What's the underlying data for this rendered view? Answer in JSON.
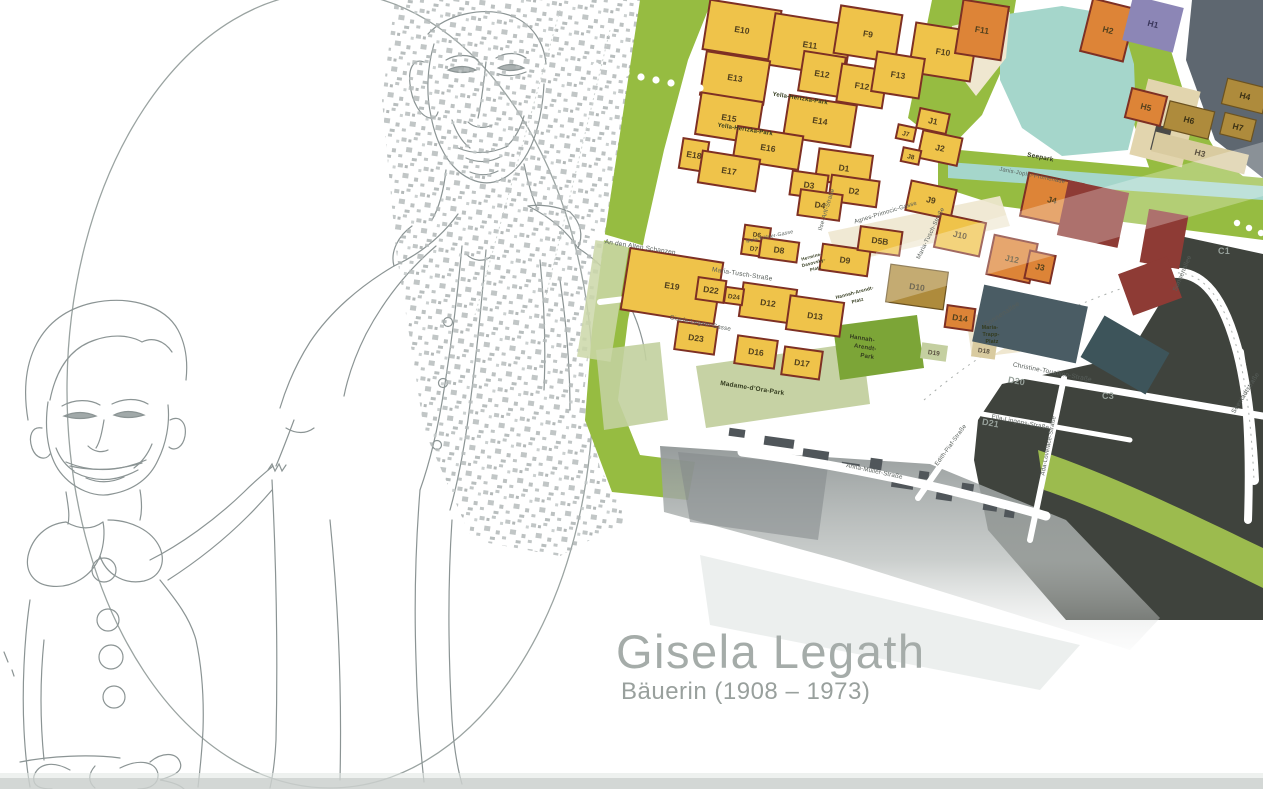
{
  "title": {
    "name": "Gisela Legath",
    "subtitle": "Bäuerin (1908 – 1973)"
  },
  "map": {
    "palette": {
      "Y": "#EFC34A",
      "O": "#DD8437",
      "OL": "#AE8B3C",
      "P": "#8C86B6",
      "MR": "#8E3B35",
      "SL": "#4A5C64",
      "SL2": "#3D545A",
      "DK": "#3F433D",
      "BG": "#D9CBA0",
      "PG": "#C4CFA0",
      "edge": "#7E3024",
      "street_label": "#575E5A",
      "park_label": "#333B1E",
      "dark_label": "#97A19B",
      "block_label": "#53411D"
    },
    "blocks": [
      [
        "E10",
        742,
        30,
        72,
        50,
        9,
        "Y"
      ],
      [
        "E11",
        810,
        45,
        78,
        52,
        9,
        "Y"
      ],
      [
        "F9",
        868,
        34,
        62,
        48,
        9,
        "Y"
      ],
      [
        "F10",
        943,
        52,
        62,
        50,
        9,
        "Y"
      ],
      [
        "F11",
        982,
        30,
        46,
        54,
        9,
        "O"
      ],
      [
        "H2",
        1108,
        30,
        44,
        54,
        14,
        "O"
      ],
      [
        "H1",
        1153,
        24,
        52,
        46,
        14,
        "P"
      ],
      [
        "E13",
        735,
        78,
        64,
        44,
        9,
        "Y"
      ],
      [
        "E12",
        822,
        74,
        42,
        40,
        9,
        "Y"
      ],
      [
        "F12",
        862,
        86,
        46,
        38,
        9,
        "Y"
      ],
      [
        "F13",
        898,
        75,
        48,
        40,
        9,
        "Y"
      ],
      [
        "E15",
        729,
        118,
        62,
        42,
        9,
        "Y"
      ],
      [
        "E14",
        820,
        121,
        68,
        42,
        9,
        "Y"
      ],
      [
        "E16",
        768,
        148,
        66,
        34,
        9,
        "Y"
      ],
      [
        "E18",
        694,
        155,
        26,
        30,
        9,
        "Y"
      ],
      [
        "E17",
        729,
        171,
        58,
        32,
        9,
        "Y"
      ],
      [
        "E19",
        672,
        286,
        94,
        62,
        9,
        "Y"
      ],
      [
        "J1",
        933,
        121,
        30,
        20,
        12,
        "Y"
      ],
      [
        "J7",
        906,
        133,
        18,
        14,
        12,
        "Y"
      ],
      [
        "J2",
        940,
        148,
        40,
        28,
        12,
        "Y"
      ],
      [
        "J8",
        911,
        156,
        18,
        14,
        12,
        "Y"
      ],
      [
        "J9",
        931,
        200,
        46,
        30,
        12,
        "Y"
      ],
      [
        "J10",
        960,
        235,
        46,
        34,
        12,
        "Y"
      ],
      [
        "J12",
        1012,
        259,
        44,
        40,
        12,
        "O"
      ],
      [
        "J3",
        1040,
        267,
        26,
        28,
        12,
        "O"
      ],
      [
        "J4",
        1052,
        200,
        56,
        44,
        12,
        "O"
      ],
      [
        "",
        1093,
        214,
        62,
        56,
        12,
        "MR"
      ],
      [
        "",
        1164,
        239,
        40,
        54,
        10,
        "MR"
      ],
      [
        "",
        1150,
        286,
        52,
        44,
        -20,
        "MR"
      ],
      [
        "H5",
        1146,
        107,
        36,
        30,
        14,
        "O"
      ],
      [
        "H3",
        1200,
        153,
        96,
        20,
        14,
        "BG"
      ],
      [
        "H6",
        1189,
        120,
        46,
        28,
        14,
        "OL"
      ],
      [
        "H4",
        1245,
        96,
        42,
        26,
        14,
        "OL"
      ],
      [
        "H7",
        1238,
        127,
        32,
        22,
        14,
        "OL"
      ],
      [
        "D1",
        844,
        168,
        54,
        32,
        8,
        "Y"
      ],
      [
        "D2",
        854,
        191,
        48,
        26,
        8,
        "Y"
      ],
      [
        "D3",
        809,
        185,
        36,
        24,
        8,
        "Y"
      ],
      [
        "D4",
        820,
        205,
        42,
        26,
        8,
        "Y"
      ],
      [
        "D6",
        757,
        234,
        26,
        15,
        8,
        "Y"
      ],
      [
        "D7",
        754,
        248,
        24,
        15,
        8,
        "Y"
      ],
      [
        "D8",
        779,
        250,
        38,
        20,
        8,
        "Y"
      ],
      [
        "D9",
        845,
        260,
        48,
        26,
        8,
        "Y"
      ],
      [
        "D5B",
        880,
        241,
        42,
        24,
        8,
        "Y"
      ],
      [
        "D10",
        917,
        287,
        58,
        38,
        8,
        "OL"
      ],
      [
        "D12",
        768,
        303,
        54,
        34,
        8,
        "Y"
      ],
      [
        "D13",
        815,
        316,
        54,
        34,
        8,
        "Y"
      ],
      [
        "D22",
        711,
        290,
        28,
        22,
        8,
        "Y"
      ],
      [
        "D24",
        734,
        296,
        18,
        16,
        8,
        "Y"
      ],
      [
        "D23",
        696,
        338,
        40,
        28,
        8,
        "Y"
      ],
      [
        "D16",
        756,
        352,
        40,
        28,
        8,
        "Y"
      ],
      [
        "D17",
        802,
        363,
        38,
        28,
        8,
        "Y"
      ],
      [
        "D14",
        960,
        318,
        28,
        22,
        8,
        "O"
      ],
      [
        "D18",
        984,
        350,
        24,
        16,
        8,
        "BG"
      ],
      [
        "D19",
        934,
        352,
        26,
        16,
        8,
        "PG"
      ],
      [
        "",
        1030,
        324,
        106,
        58,
        12,
        "SL"
      ],
      [
        "",
        1125,
        355,
        75,
        48,
        30,
        "SL2"
      ]
    ],
    "street_labels": [
      [
        "An den Alten Schanzen",
        640,
        249,
        9,
        6.5
      ],
      [
        "Maria-Tusch-Straße",
        742,
        276,
        9,
        6.5
      ],
      [
        "Maria-Tusch-Straße",
        932,
        234,
        -64,
        6
      ],
      [
        "Ilse-Arlt-Straße",
        828,
        210,
        -73,
        6
      ],
      [
        "Agnes-Primocic-Gasse",
        886,
        214,
        -17,
        6
      ],
      [
        "Gisela-Legath-Gasse",
        700,
        325,
        11,
        6.2
      ],
      [
        "Sonnenallee",
        1003,
        316,
        -33,
        7
      ],
      [
        "Sonnenallee",
        1184,
        274,
        -67,
        6.5
      ],
      [
        "Christine-Touaillon-Straße",
        1052,
        374,
        11,
        6.5
      ],
      [
        "Ella-Lingens-Straße",
        1020,
        424,
        11,
        6.2
      ],
      [
        "Ada-Lovelace-Straße",
        1050,
        446,
        -79,
        6
      ],
      [
        "Edith-Piaf-Straße",
        952,
        446,
        -54,
        6
      ],
      [
        "Anna-Müller-Straße",
        874,
        473,
        12,
        6.2
      ],
      [
        "Seestadtstraße",
        1247,
        394,
        -58,
        6.5
      ],
      [
        "Janis-Joplin-Promenade",
        1032,
        177,
        11,
        5.8
      ],
      [
        "Mela-Köhler-Gasse",
        770,
        238,
        -12,
        5.2
      ]
    ],
    "park_labels": [
      [
        "Yella-Hertzka-Park",
        800,
        100,
        9,
        6
      ],
      [
        "Yella-Hertzka-Park",
        745,
        131,
        9,
        6
      ],
      [
        "Seepark",
        1040,
        159,
        11,
        6.5
      ],
      [
        "Hannah-",
        862,
        340,
        9,
        6
      ],
      [
        "Arendt-",
        865,
        349,
        9,
        6
      ],
      [
        "Park",
        867,
        358,
        9,
        6
      ],
      [
        "Madame-d’Ora-Park",
        752,
        390,
        9,
        6.5
      ],
      [
        "Maria-",
        990,
        329,
        0,
        5.2
      ],
      [
        "Trapp-",
        991,
        336,
        0,
        5.2
      ],
      [
        "Platz",
        992,
        343,
        0,
        5.2
      ],
      [
        "Hannah-Arendt-",
        855,
        294,
        -15,
        4.8
      ],
      [
        "Platz",
        858,
        302,
        -15,
        4.8
      ],
      [
        "Hermine-",
        812,
        258,
        -15,
        4.5
      ],
      [
        "Dasovsky-",
        814,
        264,
        -15,
        4.5
      ],
      [
        "Platz",
        816,
        270,
        -15,
        4.5
      ]
    ],
    "area_labels": [
      [
        "C1",
        1224,
        254,
        0,
        9
      ],
      [
        "C3",
        1108,
        399,
        0,
        9
      ],
      [
        "D20",
        1016,
        384,
        10,
        9
      ],
      [
        "D21",
        990,
        426,
        10,
        9
      ]
    ]
  }
}
